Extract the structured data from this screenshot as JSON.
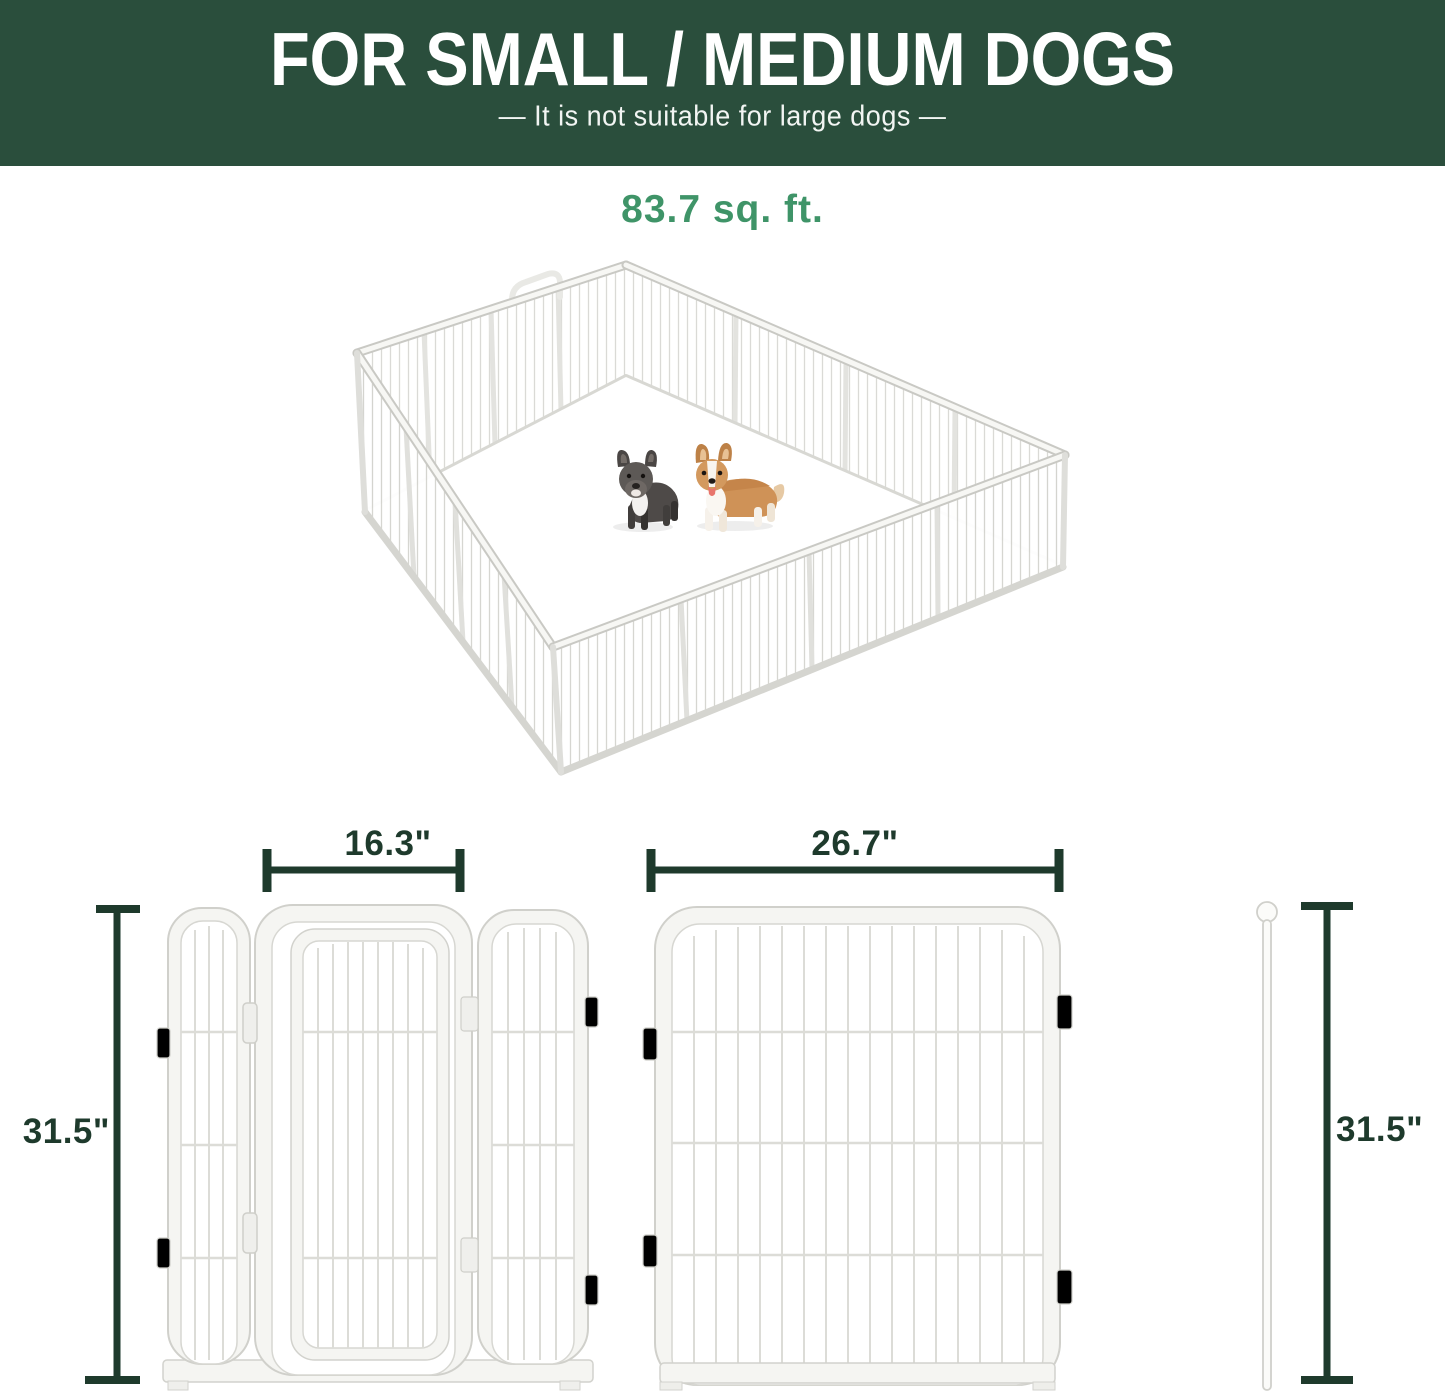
{
  "header": {
    "title": "FOR SMALL / MEDIUM DOGS",
    "subtitle": "—  It is not suitable for large dogs  —"
  },
  "playpen": {
    "area_label": "83.7 sq. ft.",
    "contents": [
      "french-bulldog",
      "corgi"
    ],
    "panel_count_visible": 16
  },
  "dimensions": {
    "door_panel_width": "16.3\"",
    "large_panel_width": "26.7\"",
    "panel_height": "31.5\"",
    "rod_height": "31.5\""
  },
  "colors": {
    "header_bg": "#2a4e3c",
    "header_text": "#ffffff",
    "area_green": "#3f9468",
    "dimension_green": "#1e3a2c",
    "panel_line": "#d2d2cd",
    "panel_fill": "#f5f5f2"
  }
}
